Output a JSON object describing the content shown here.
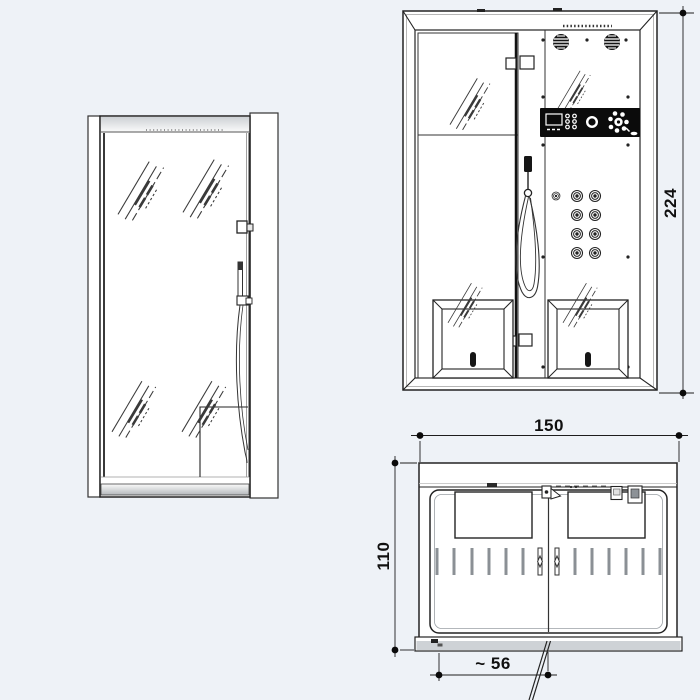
{
  "drawing": {
    "kind": "technical-drawing",
    "colors": {
      "background": "#eef2f7",
      "line": "#232323",
      "panel_black": "#0b0b0b",
      "shade_gray": "#ced2d6"
    },
    "dimensions": {
      "height": "224",
      "width": "150",
      "depth": "110",
      "door_clearance": "~ 56"
    }
  }
}
